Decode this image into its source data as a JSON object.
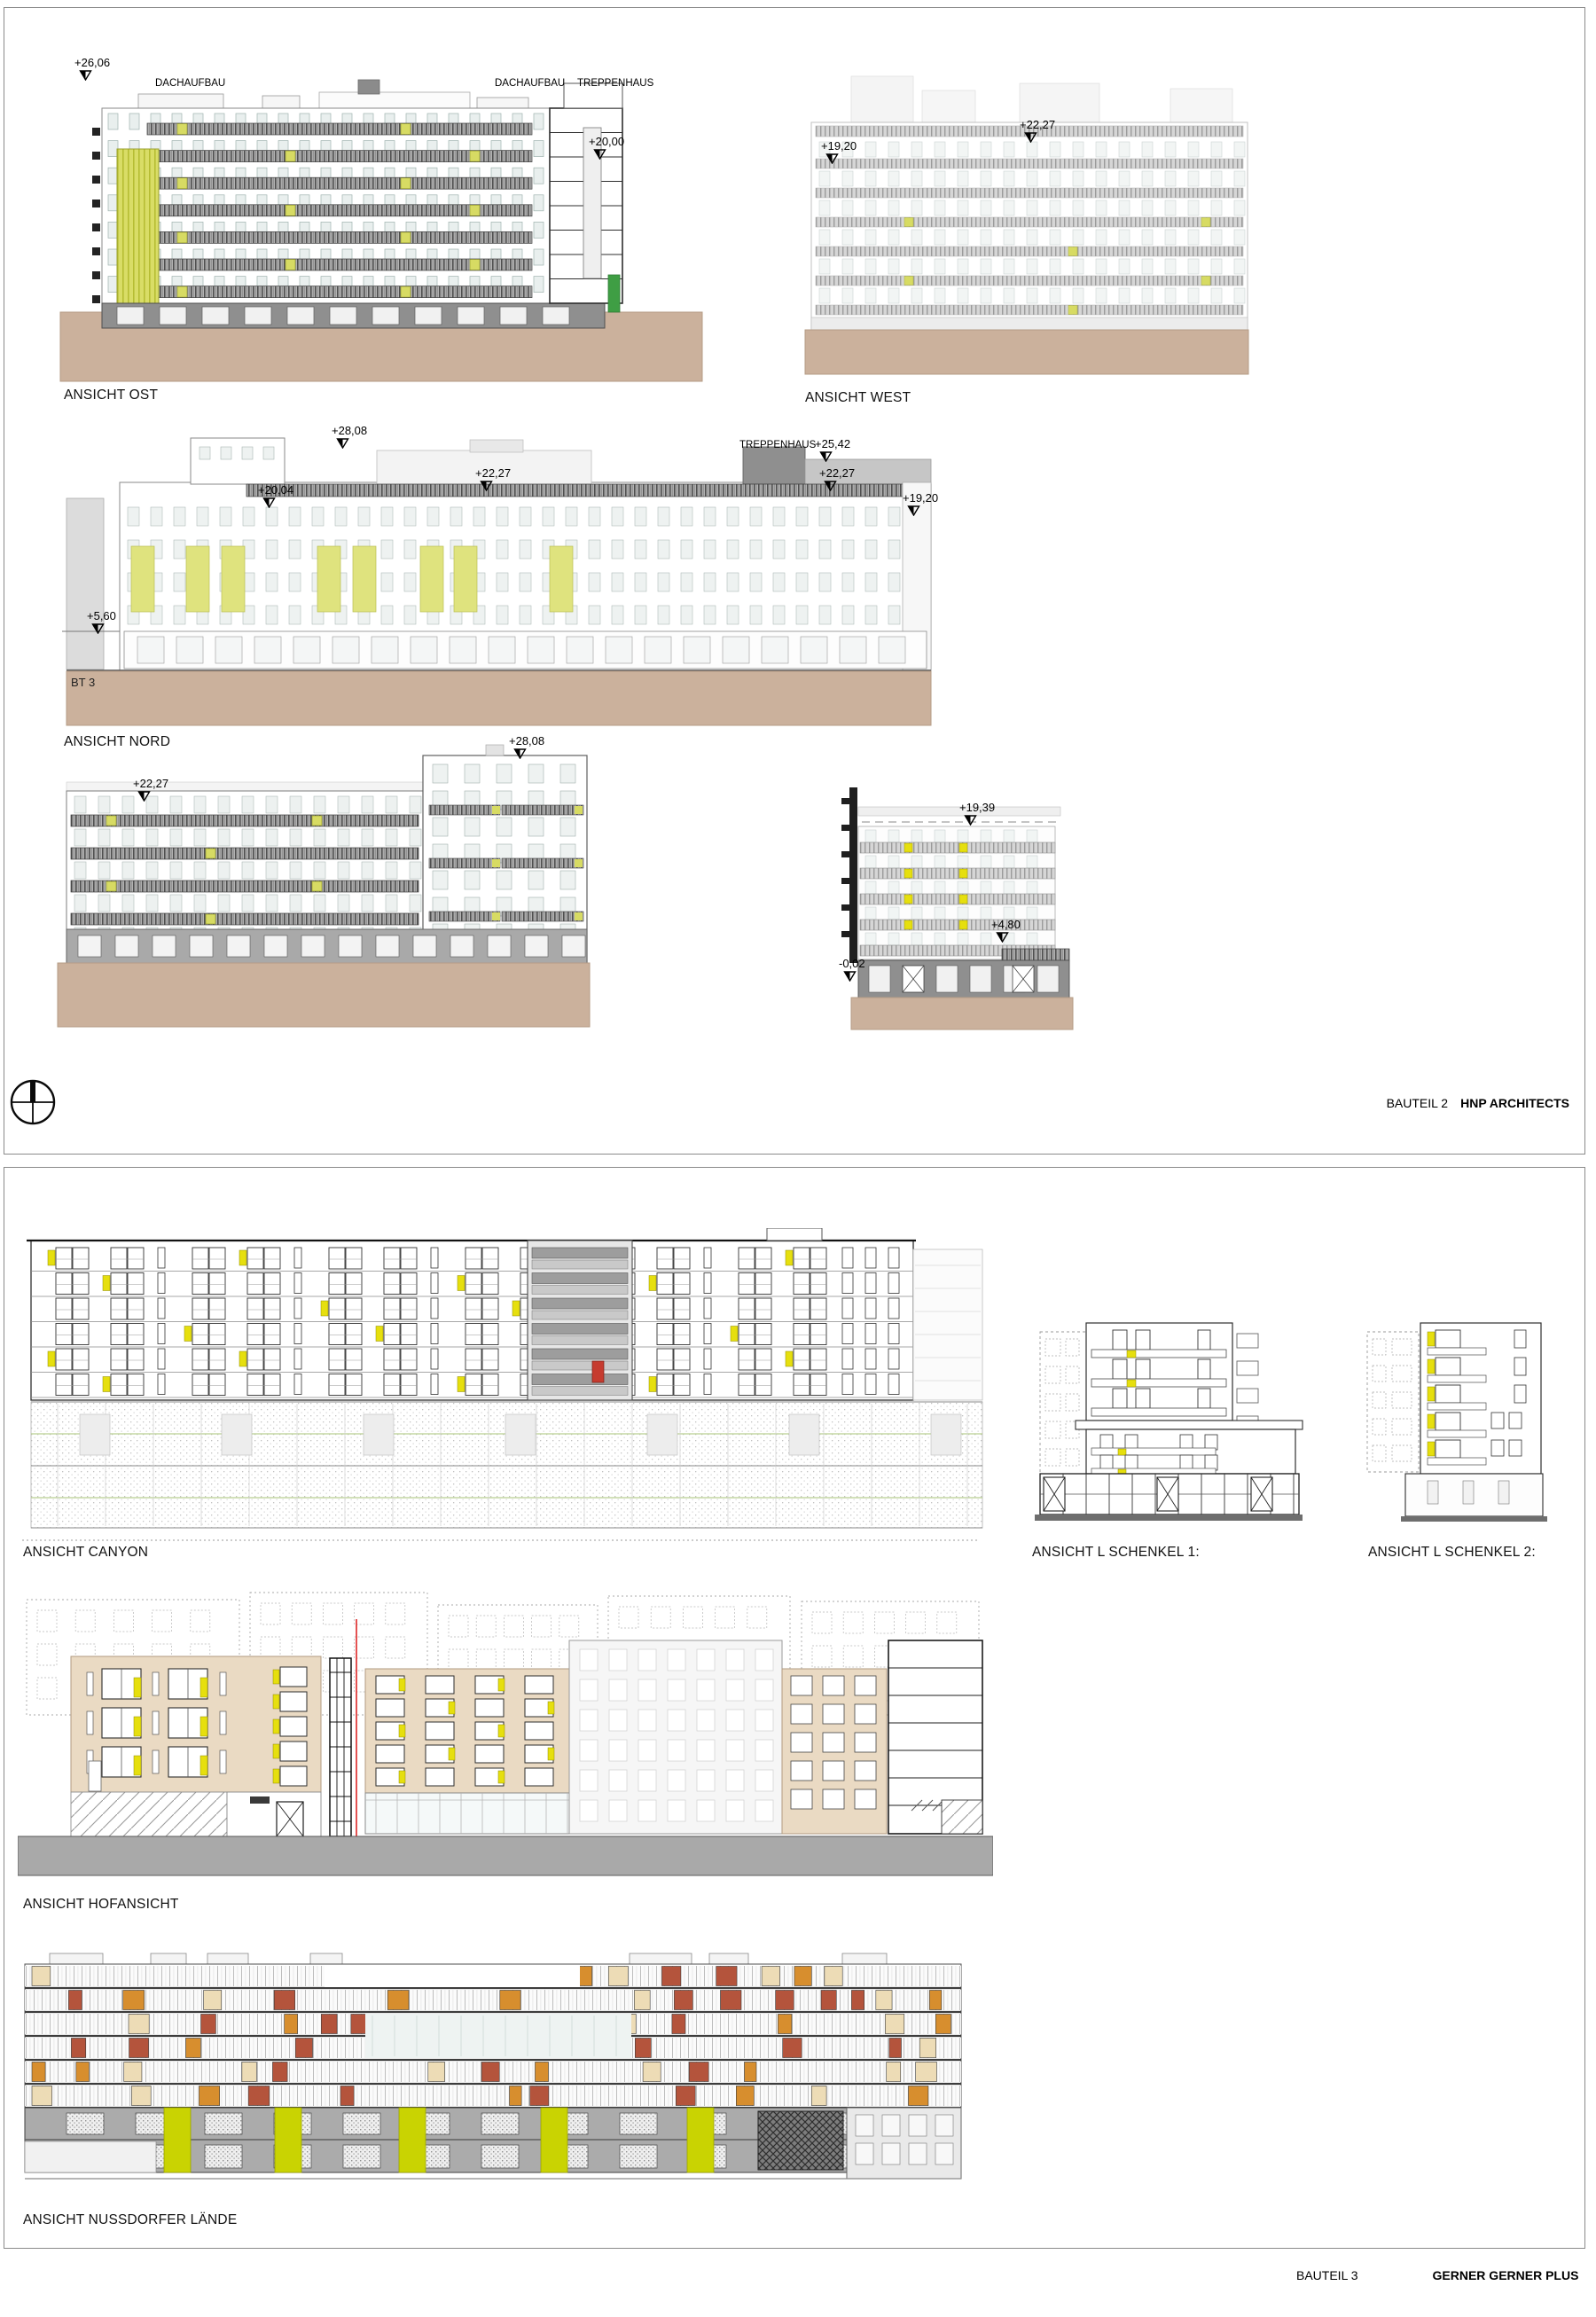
{
  "colors": {
    "accent_lime": "#d7db63",
    "accent_lime_pale": "#dfe37e",
    "accent_yellow": "#e6df0e",
    "accent_chartreuse": "#c9d302",
    "ground_tan": "#cbb19c",
    "ground_gray": "#a9a9a9",
    "facade_beige": "#eadac3",
    "panel_red": "#b4543c",
    "panel_orange": "#d78e2e",
    "panel_cream": "#eddcb6",
    "section_red_line": "#e03434",
    "section_green": "#3f9e44"
  },
  "top_panel": {
    "footer": {
      "part": "BAUTEIL 2",
      "firm": "HNP ARCHITECTS"
    },
    "drawings": {
      "ost": {
        "label": "ANSICHT OST",
        "markers": {
          "top": "+26,06",
          "dach_left": "DACHAUFBAU",
          "dach_right": "DACHAUFBAU",
          "treppenhaus": "TREPPENHAUS",
          "m2000": "+20,00"
        }
      },
      "west": {
        "label": "ANSICHT WEST",
        "markers": {
          "m2227": "+22,27",
          "m1920": "+19,20"
        }
      },
      "nord": {
        "label": "ANSICHT NORD",
        "bt": "BT 3",
        "markers": {
          "m2808": "+28,08",
          "m2004": "+20,04",
          "m2227a": "+22,27",
          "treppenhaus": "TREPPENHAUS",
          "m2542": "+25,42",
          "m2227b": "+22,27",
          "m1920": "+19,20",
          "m560": "+5,60"
        }
      },
      "sued": {
        "markers": {
          "m2227": "+22,27",
          "m2808": "+28,08"
        }
      },
      "side": {
        "markers": {
          "m1939": "+19,39",
          "m480": "+4,80",
          "m002": "-0,02"
        }
      }
    }
  },
  "bottom_panel": {
    "footer": {
      "part": "BAUTEIL 3",
      "firm": "GERNER GERNER PLUS"
    },
    "drawings": {
      "canyon": {
        "label": "ANSICHT CANYON"
      },
      "schenkel1": {
        "label": "ANSICHT L SCHENKEL 1:"
      },
      "schenkel2": {
        "label": "ANSICHT L SCHENKEL 2:"
      },
      "hof": {
        "label": "ANSICHT HOFANSICHT"
      },
      "nussdorfer": {
        "label": "ANSICHT NUSSDORFER LÄNDE"
      }
    }
  }
}
